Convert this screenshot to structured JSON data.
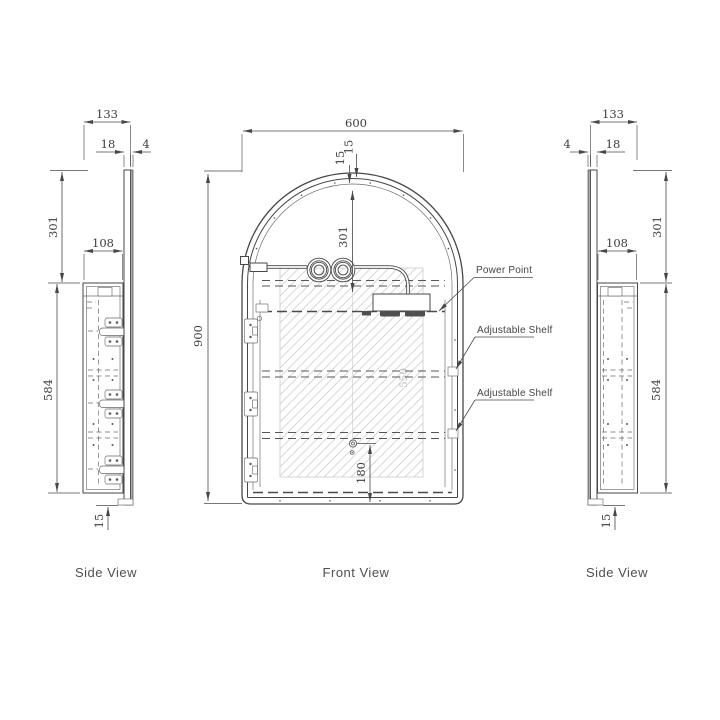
{
  "views": {
    "left_side": {
      "label": "Side View",
      "dims": {
        "total_depth": "133",
        "door_thickness": "18",
        "glass_thickness": "4",
        "top_height": "301",
        "cabinet_depth": "108",
        "cabinet_height": "584",
        "bottom_gap": "15"
      }
    },
    "front": {
      "label": "Front View",
      "dims": {
        "width": "600",
        "frame_outer": "15",
        "frame_inner": "15",
        "arch_height": "301",
        "total_height": "900",
        "mirror_height": "550",
        "power_height": "180"
      },
      "callouts": {
        "power_point": "Power Point",
        "adjustable_shelf_1": "Adjustable Shelf",
        "adjustable_shelf_2": "Adjustable Shelf"
      }
    },
    "right_side": {
      "label": "Side View",
      "dims": {
        "total_depth": "133",
        "glass_thickness": "4",
        "door_thickness": "18",
        "top_height": "301",
        "cabinet_depth": "108",
        "cabinet_height": "584",
        "bottom_gap": "15"
      }
    }
  },
  "colors": {
    "line": "#474747",
    "dim_text": "#3d3d3d",
    "label_text": "#4f4f4f",
    "hatch": "#d8d8d8",
    "glass_fill": "#a9a9a9",
    "dark_fill": "#4f4f4f",
    "muted_text": "#bdbdbd",
    "background": "#ffffff"
  }
}
